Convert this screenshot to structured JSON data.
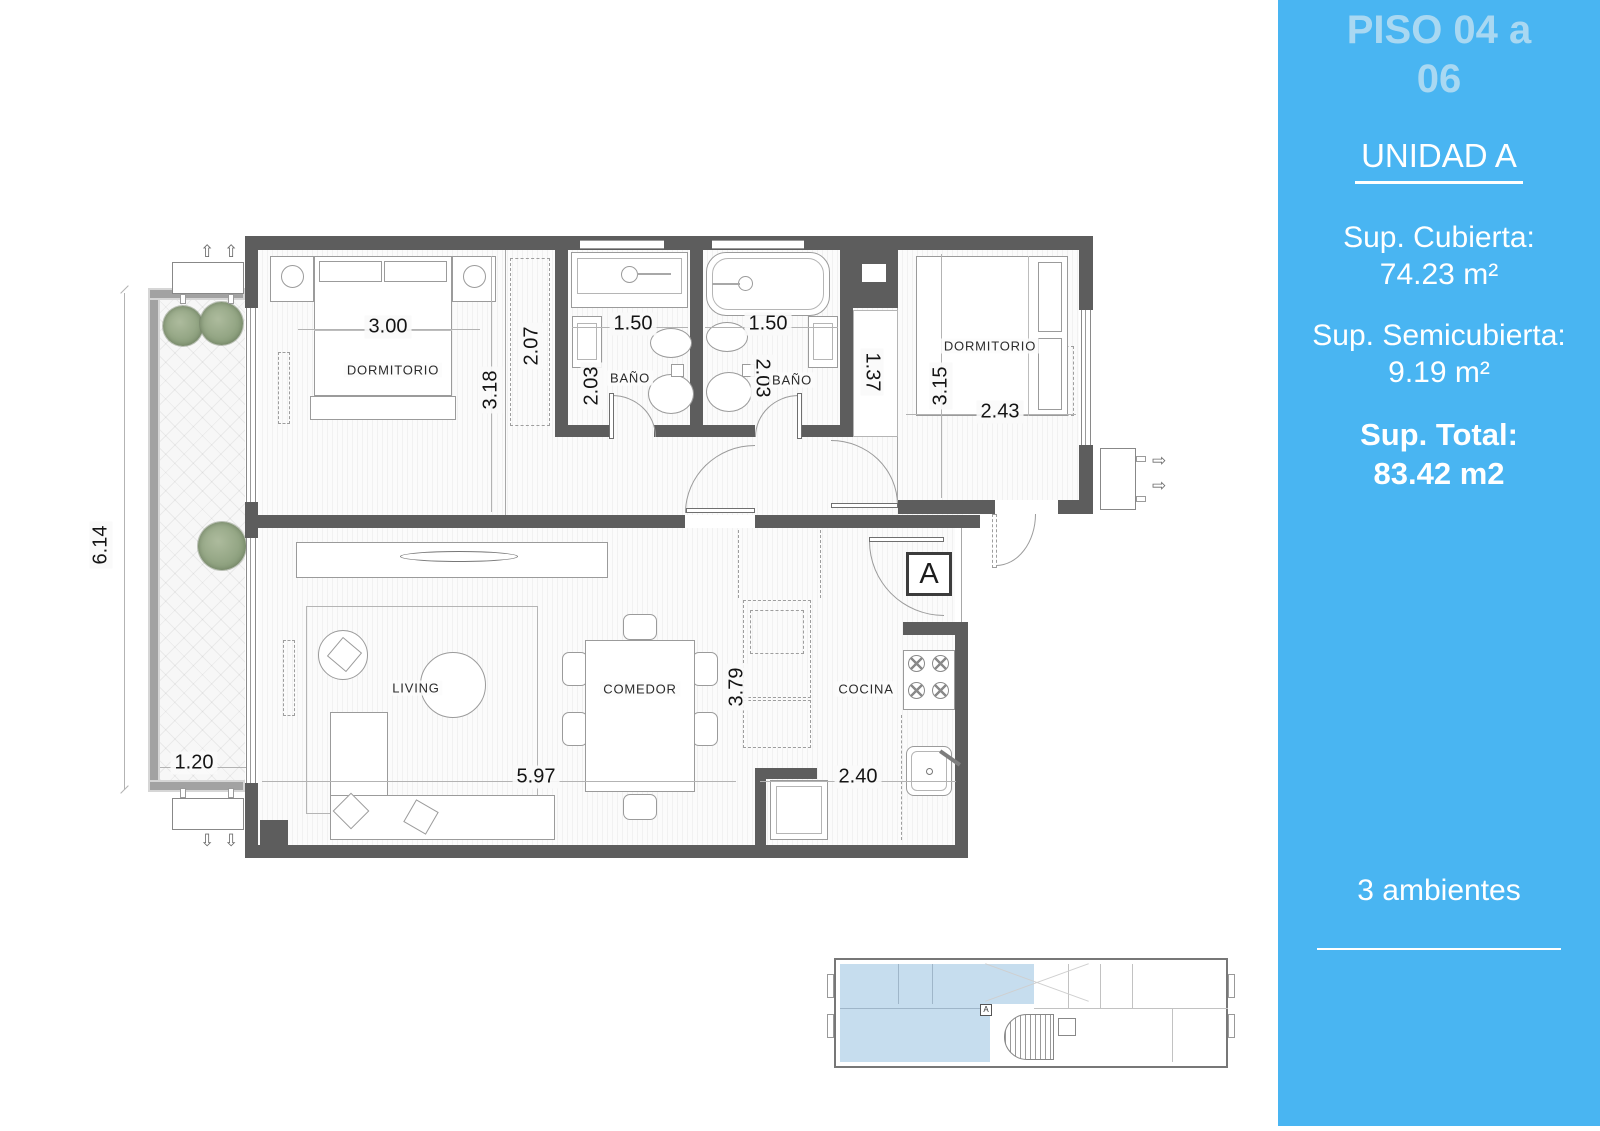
{
  "sidebar": {
    "bg_color": "#49b5f2",
    "title_color": "#a9d8f2",
    "floor_title_line1": "PISO 04 a",
    "floor_title_line2": "06",
    "unit_title": "UNIDAD A",
    "covered_label": "Sup. Cubierta:",
    "covered_value": "74.23 m²",
    "semicovered_label": "Sup. Semicubierta:",
    "semicovered_value": "9.19 m²",
    "total_label": "Sup. Total:",
    "total_value": "83.42 m2",
    "rooms_count": "3 ambientes"
  },
  "plan": {
    "unit_marker": "A",
    "wall_color": "#5d5d5d",
    "keyplan_highlight": "#c6ddee",
    "rooms": [
      "DORMITORIO",
      "BAÑO",
      "BAÑO",
      "DORMITORIO",
      "LIVING",
      "COMEDOR",
      "COCINA"
    ],
    "dims": [
      "3.00",
      "3.18",
      "2.07",
      "1.50",
      "2.03",
      "1.50",
      "2.03",
      "1.37",
      "3.15",
      "2.43",
      "6.14",
      "1.20",
      "5.97",
      "3.79",
      "2.40"
    ]
  }
}
